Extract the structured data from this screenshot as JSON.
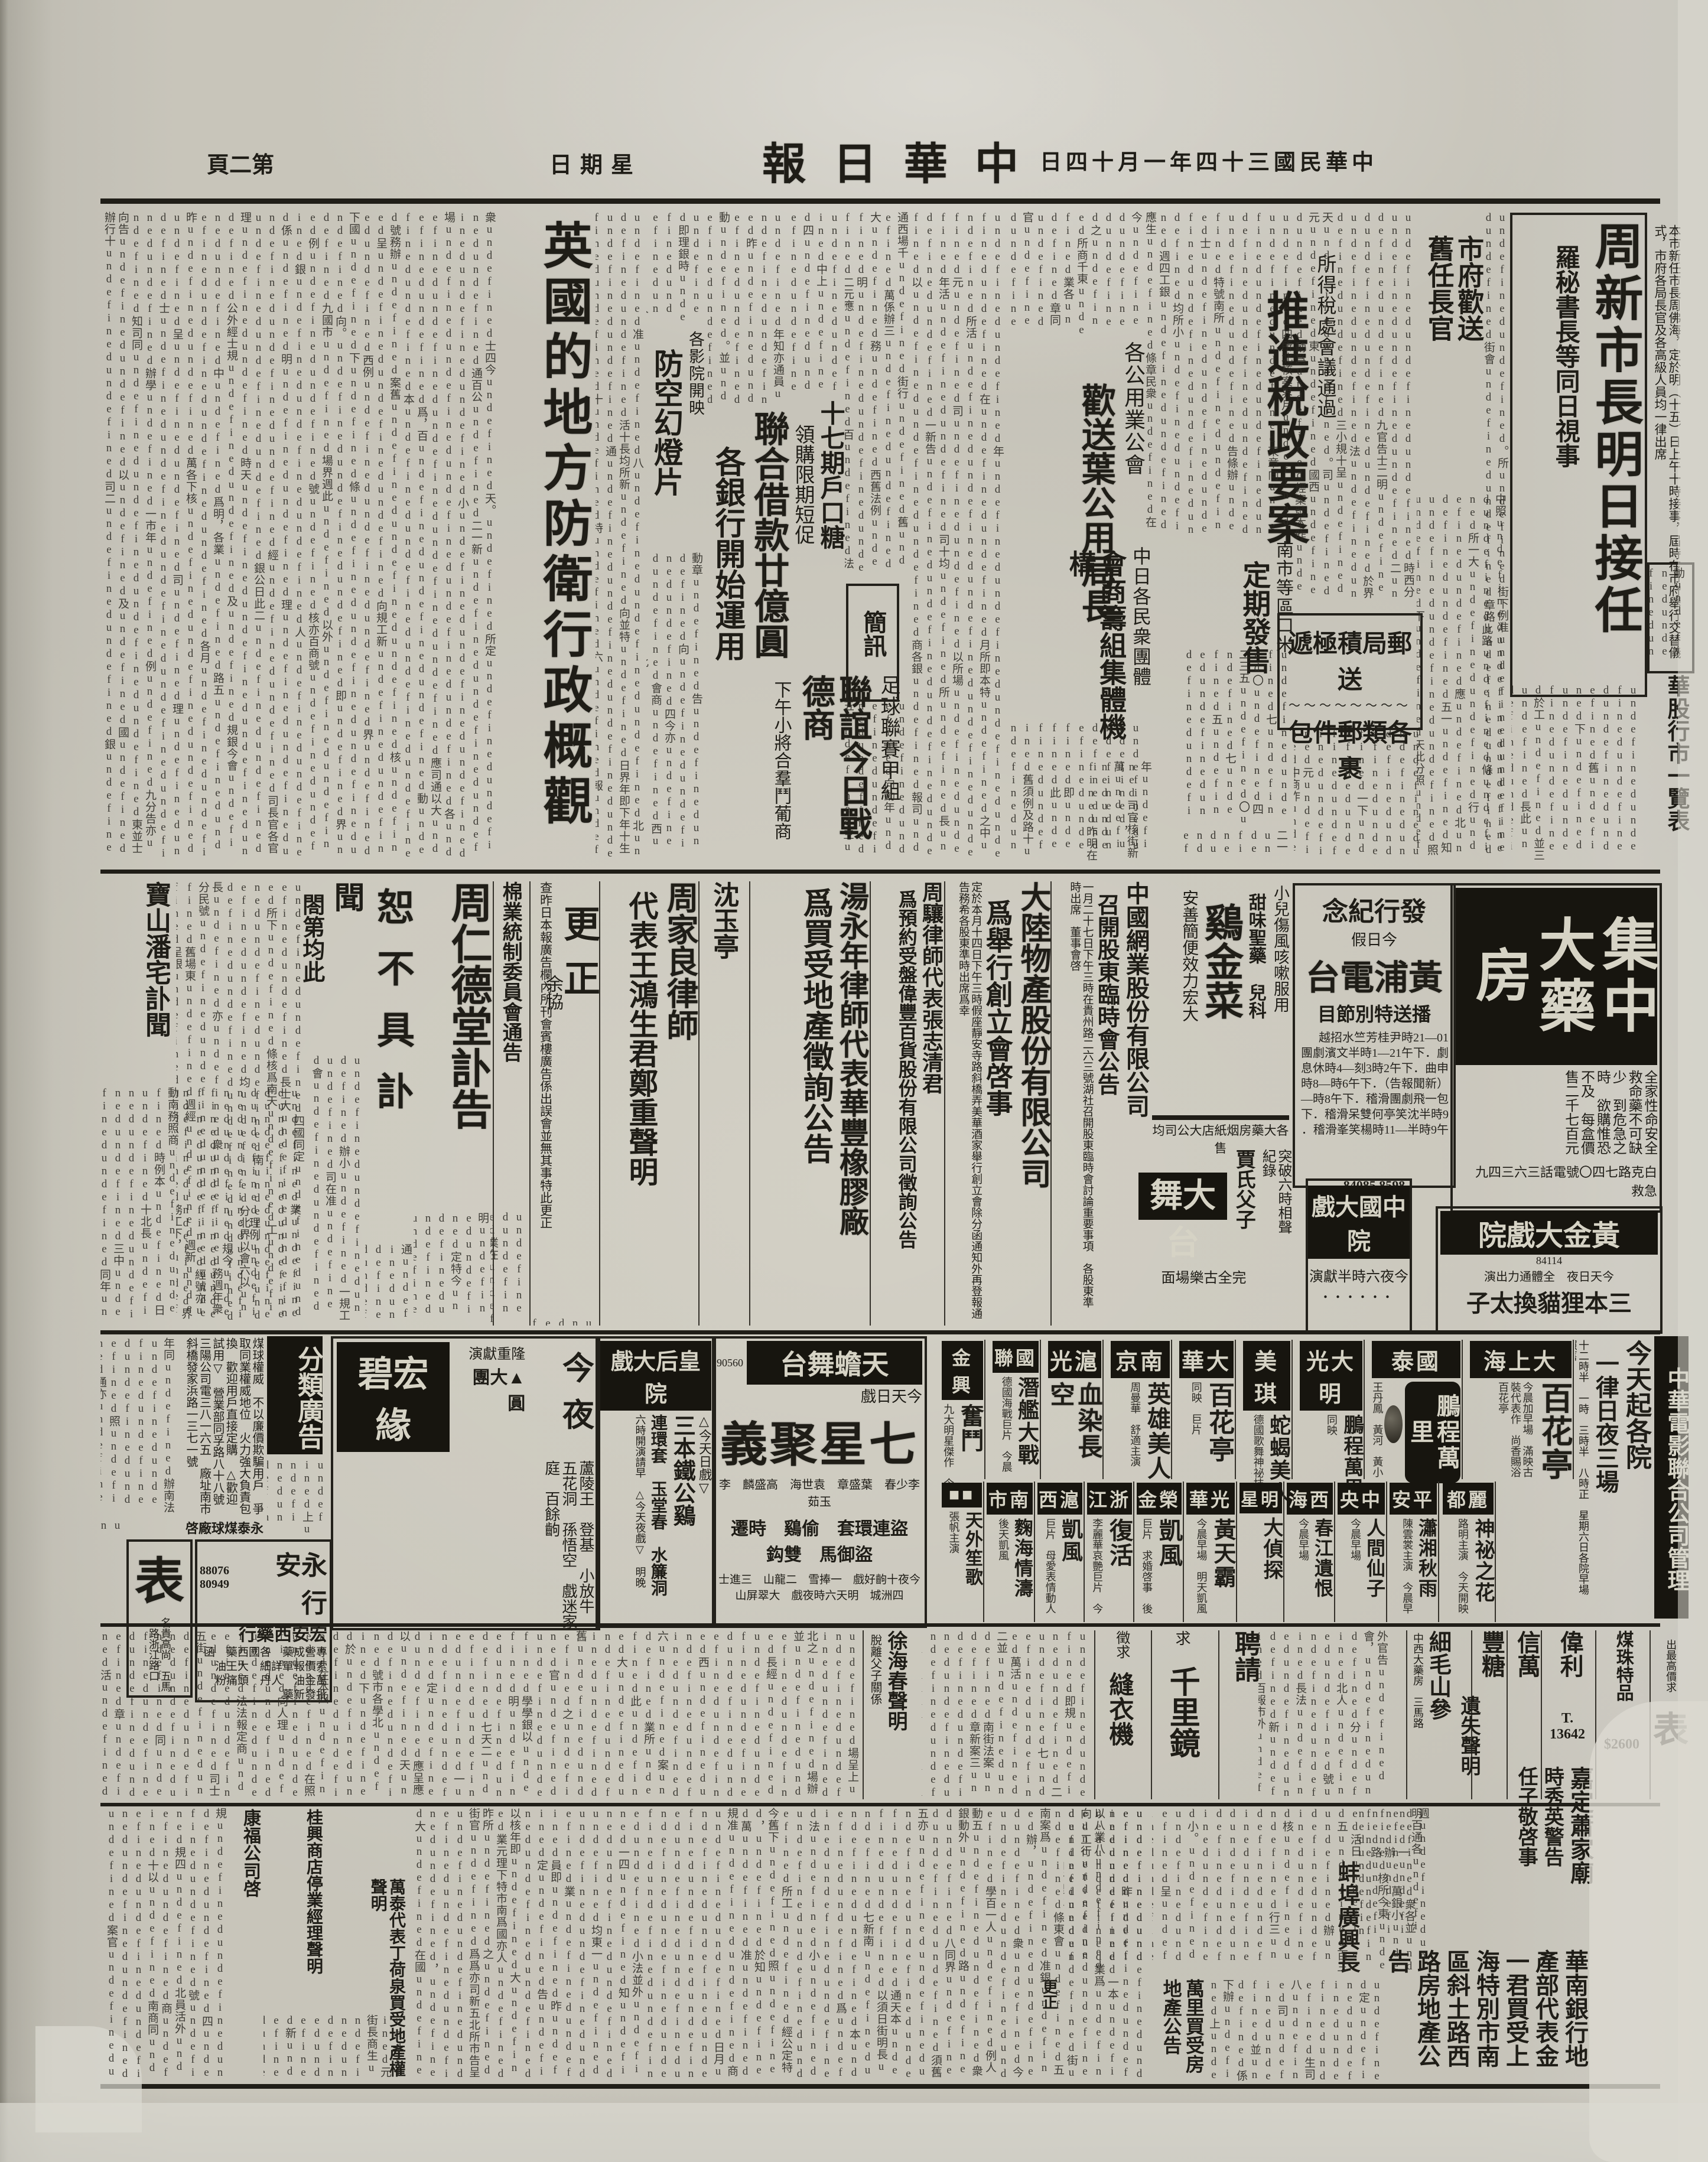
{
  "masthead": {
    "title": "中華日報",
    "date": "中華民國三十四年一月十四日",
    "weekday": "星期日",
    "page_no": "第二頁"
  },
  "lead": {
    "headline": "周新市長明日接任",
    "subhead": "羅秘書長等同日視事",
    "lede": "本市新任市長周佛海，定於明（十五）日上午十時接事，屆時在市府舉行交替儀式，市府各局長官及各高級人員均一律出席"
  },
  "news": {
    "tax": {
      "kicker": "所得稅處會議通過",
      "headline": "推進稅政要案"
    },
    "cityfarewell": {
      "headline": "市府歡送舊任長官"
    },
    "post": {
      "line1": "郵局積極遞送",
      "line2": "各類郵件包裹"
    },
    "pubutil": {
      "kicker": "各公用業公會",
      "headline": "歡送葉公用局長"
    },
    "rice": {
      "kicker": "南市等區口米",
      "headline": "定期發售"
    },
    "cj": {
      "kicker": "中日各民衆團體",
      "headline": "會商籌組集體機構"
    },
    "loan": {
      "headline": "聯合借款廿億圓",
      "subhead": "各銀行開始運用"
    },
    "sugar": {
      "headline": "十七期戶口糖",
      "subhead": "領購限期短促"
    },
    "airdef": {
      "kicker": "各影院開映",
      "headline": "防空幻燈片"
    },
    "england": {
      "headline": "英國的地方防衛行政概觀",
      "byline": "余協"
    },
    "football": {
      "kicker": "足球聯賽甲組",
      "headline": "聯誼今日戰德商",
      "subhead": "下午小將合羣鬥葡商"
    },
    "briefs": {
      "headline": "簡訊"
    },
    "stocks": {
      "headline": "華股行市一覽表"
    }
  },
  "ads": {
    "jida": {
      "name": "集中大藥房",
      "claims": "全家性命安全　救命藥不可缺少　到危急之時　欲購惟恐不及　每盒價售二千七百元",
      "address": "白克路七四〇號電話三六三四九　急救"
    },
    "radio": {
      "kicker": "發行紀念",
      "note": "今日假",
      "name": "黃浦電台",
      "subtitle": "播送特別節目",
      "schedule": "10—12時尹桂芳竺水招越劇．下午12—1時半文濱劇團申曲．下午2時3刻—4時休息（新聞報告）．下午6時—8時包一飛劇團滑稽．下午8時—9時半沈笑亭何雙呆滑稽．下午9時半—11時楊笑峯滑稽．",
      "phone": "84085 8598"
    },
    "chicken": {
      "note": "小兒傷風咳嗽服用",
      "kicker": "甜味聖藥 兒科",
      "name": "鷄金菜",
      "slogan": "安善簡便效力宏大",
      "footer": "各大藥房烟紙店大公司均售"
    },
    "cnwy": {
      "name": "中國網業股份有限公司",
      "title": "召開股東臨時會公告",
      "body": "一月二十七日下午三時在貴州路二六三號湖社召開股東臨時會討論重要事項　各股東準時出席　董事會啓"
    },
    "dalu": {
      "name": "大陸物產股份有限公司",
      "title": "爲舉行創立會啓事",
      "body": "定於本月十四日下午三時假座靜安寺路斜橋弄美華酒家舉行創立會除分函通知外再登報通告務希各股東準時出席爲幸"
    },
    "zhouxiang": {
      "name": "周驤律師代表張志清君",
      "title": "爲預約受盤偉豐百貨股份有限公司徵詢公告"
    },
    "tang": {
      "name": "湯永年律師代表華豐橡膠廠",
      "title": "爲買受地產徵詢公告"
    },
    "shen": {
      "name": "沈玉亭"
    },
    "zhoujialiang": {
      "name": "周家良律師",
      "title": "代表王鴻生君鄭重聲明"
    },
    "gengzheng": {
      "name": "更正",
      "body": "查昨日本報廣告欄內所刊會賓樓廣告係出誤會並無其事特此更正"
    },
    "cotton": {
      "name": "棉業統制委員會通告",
      "body": "第一八七七六號倉單之棉布五箱業經本會派員檢收所有上項倉單應即作廢特此通告"
    },
    "obituary": {
      "name": "周仁德堂訃告",
      "shu": "恕不具訃",
      "wen": "聞",
      "wen2": "閤第均此"
    },
    "baoshan": {
      "name": "寶山潘宅訃聞"
    },
    "coal": {
      "name": "永泰煤球廠啓",
      "lines": "煤球權威　不以廉價欺騙用戶　爭取同業權威地位　火力強大負責包換　歡迎用戶直接定購　△歡迎試用▽　營業部同孚路八十八號三陽公司電三八一六五　廠址南市斜橋發家浜路一三七一號"
    },
    "classified_banner": {
      "name": "分類廣告"
    },
    "bengbeng": {
      "time": "今夜",
      "note": "隆重獻演",
      "feature": "▲大團圓",
      "name": "宏碧緣",
      "plays": "蘆陵王　登基　小放牛　五花洞　孫悟空　戲迷家庭　百餘齣"
    },
    "yongan": {
      "name": "永安行",
      "phone": "88076 80949",
      "sub": "宏安西藥行",
      "lines": "專營成藥　各國西藥　函索價報單詳細　大王油　萬金油　人丹　頭痛粉　批發新藥"
    },
    "watch": {
      "name": "表",
      "note": "名貴高尚　五馬路浙江路口"
    },
    "goldtheater": {
      "name": "黃金大戲院",
      "phone": "84114",
      "note": "今天日夜　全體通力出演",
      "film": "三本狸貓換太子",
      "next": "明天四本狸貓換太子"
    },
    "dawutai": {
      "name": "大舞台",
      "note1": "突破六時相聲紀錄",
      "note2": "賈氏父子",
      "note3": "完全古樂場面"
    },
    "zhongguo": {
      "name": "中國大戲院",
      "note": "今夜六時半獻演"
    }
  },
  "cinema": {
    "banner": "中華電影聯合公司管理",
    "schedule": {
      "line1": "今天起各院",
      "line2": "一律日夜三場",
      "note": "十二時半　一時　三時半　八時正　星期六日各院早場照舊"
    },
    "row1": [
      {
        "name": "大上海",
        "film": "百花亭",
        "note": "今晨加早場　滿映古裝代表作　尚香賜浴百花亭"
      },
      {
        "name": "國泰",
        "film": "鵬程萬里",
        "note": "王丹鳳　黃河　黃小珠　鄭小秋　孤兒奮鬥史　後天起映江湖三傑"
      },
      {
        "name": "大光明",
        "film": "鵬程萬里",
        "note": "同映"
      },
      {
        "name": "美琪",
        "film": "蛇蝎美人",
        "note": "德國歌舞神祕技術巨片　後天開映"
      },
      {
        "name": "大華",
        "film": "百花亭",
        "note": "同映　巨片"
      },
      {
        "name": "南京",
        "film": "英雄美人",
        "note": "周曼華　舒適主演"
      },
      {
        "name": "滬光",
        "film": "血染長空",
        "note": "日本最大壯烈偉大空戰巨片　渾身是膽　後天又一巨片"
      },
      {
        "name": "國聯",
        "film": "潛艦大戰",
        "note": "德國海戰巨片　今晨十時半加早場"
      },
      {
        "name": "金興",
        "film": "奮鬥",
        "note": "九大明星傑作　今晨早場　在暗黑中搏取光明"
      }
    ],
    "stage": [
      {
        "name": "天蟾舞台",
        "phone": "90560",
        "kicker": "今天日戲",
        "film": "七星聚義",
        "actors": "李少春　葉盛章　袁世海　高盛麟　李玉茹",
        "plays": "盜連環套　偷鷄　時遷　盜御馬　雙鈎",
        "note": "今夜十齣好戲　一捧雪　二龍山　三進士　四洲城　明天六時夜戲　大翠屏山"
      },
      {
        "name": "皇后大戲院",
        "kicker": "△今天日戲▽",
        "film": "三本鐵公鷄",
        "plays": "連環套　玉堂春　水簾洞",
        "note": "六時開演請早　△今天夜戲▽　明晚"
      }
    ],
    "row2": [
      {
        "name": "麗都",
        "film": "神祕之花",
        "note": "路明主演　今天開映"
      },
      {
        "name": "平安",
        "film": "瀟湘秋雨",
        "note": "陳雲裳主演　今晨早場"
      },
      {
        "name": "中央",
        "film": "人間仙子",
        "note": "今晨早場"
      },
      {
        "name": "西海",
        "film": "春江遺恨",
        "note": "今晨早場"
      },
      {
        "name": "明星",
        "film": "大偵探",
        "note": ""
      },
      {
        "name": "光華",
        "film": "黃天霸",
        "note": "今晨早場　明天凱風"
      },
      {
        "name": "榮金",
        "film": "凱風",
        "note": "巨片　求婚啓事　後天開映"
      },
      {
        "name": "浙江",
        "film": "復活",
        "note": "李麗華哀艷巨片　今晨早場"
      },
      {
        "name": "滬西",
        "film": "凱風",
        "note": "巨片　母愛表情動人"
      },
      {
        "name": "南市",
        "film": "麴海情濤",
        "note": "後天凱風"
      },
      {
        "name": "■■",
        "film": "天外笙歌",
        "note": "張帆主演"
      }
    ]
  },
  "smallads": [
    {
      "name": "表",
      "note": "出最高價求"
    },
    {
      "name": "煤珠特品",
      "note": "$2600"
    },
    {
      "name": "偉利",
      "note": "T. 13642"
    },
    {
      "name": "信萬",
      "note": ""
    },
    {
      "name": "豐糖",
      "note": ""
    },
    {
      "name": "細毛山參",
      "note": "中西大藥房　三馬路"
    },
    {
      "name": "聘請",
      "note": ""
    },
    {
      "name": "千里鏡",
      "note": "求"
    },
    {
      "name": "縫衣機",
      "note": "徵求"
    },
    {
      "name": "徐海春聲明",
      "note": "脫離父子關係"
    }
  ],
  "bottom": {
    "yishi": "遺失聲明",
    "jiading1": "嘉定蕭家廟",
    "jiading2": "時秀英警告",
    "jiading3": "任子敬啓事",
    "huanan": "華南銀行地產部代表金一君買受上海特別市南區斜土路西路房地產公告",
    "bengbu": "蚌埠廣興長",
    "wanli": "萬里買受房地產公告",
    "wantai": "萬泰代表丁荷泉買受地產權聲明",
    "kangfu": "康福公司啓",
    "guixing": "桂興商店停業經理聲明",
    "gz": "更正"
  }
}
